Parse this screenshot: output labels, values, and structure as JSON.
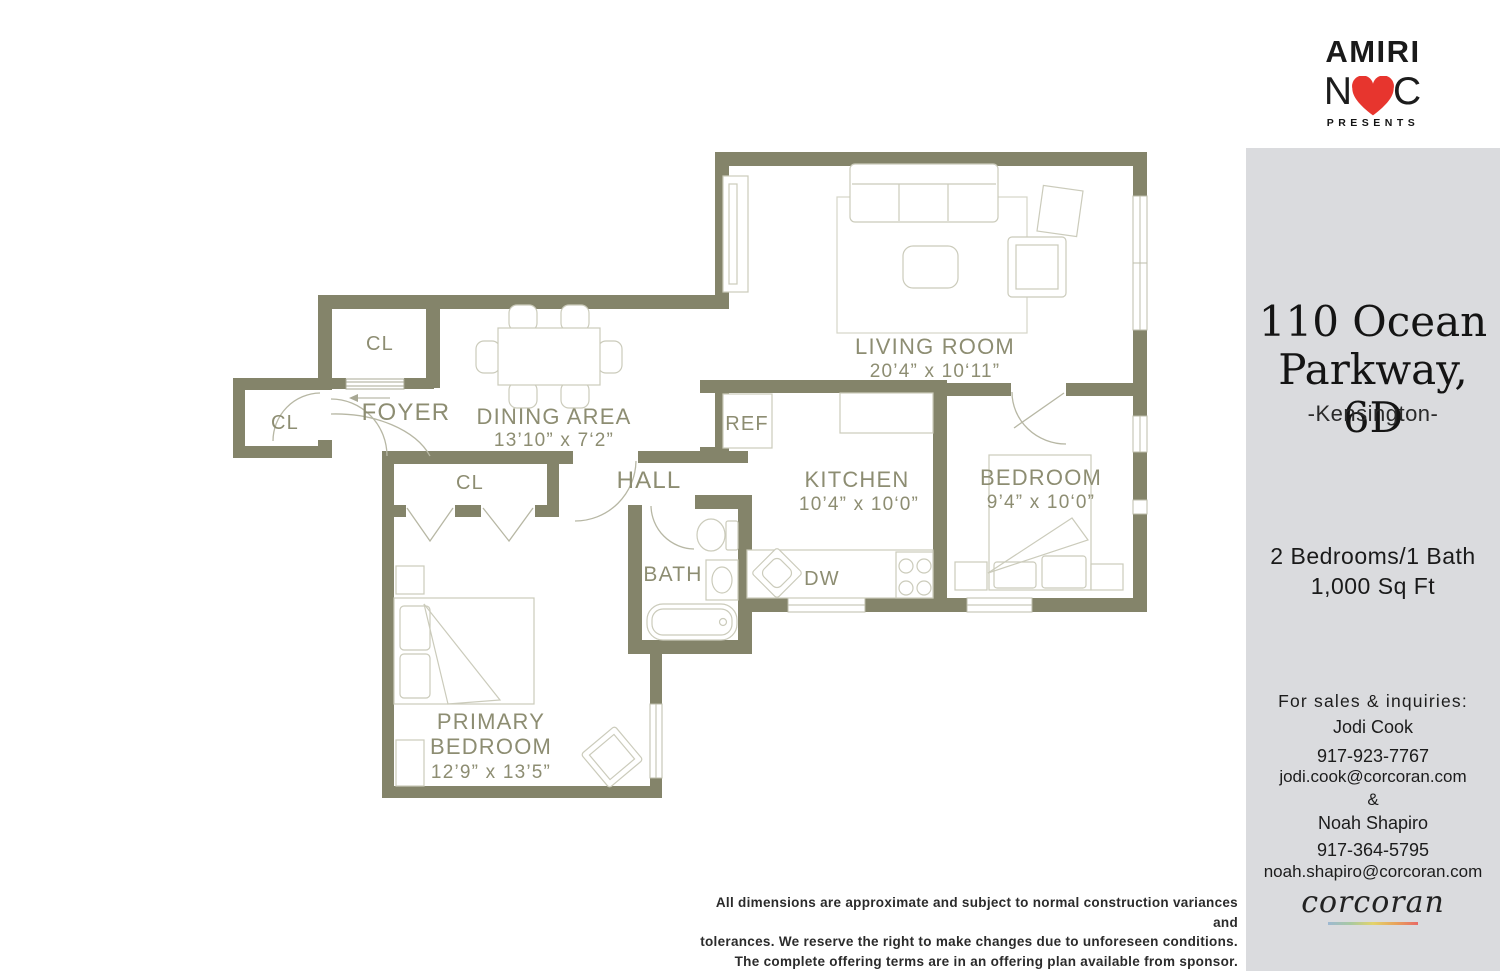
{
  "brand": {
    "name": "AMIRI",
    "monogram_left": "N",
    "monogram_right": "C",
    "presents": "PRESENTS",
    "heart_color": "#e7352e"
  },
  "sidebar": {
    "address_line1": "110 Ocean",
    "address_line2": "Parkway, 6D",
    "neighborhood": "-Kensington-",
    "beds_baths": "2 Bedrooms/1 Bath",
    "area": "1,000 Sq Ft",
    "contact_heading": "For sales & inquiries:",
    "agents": [
      {
        "name": "Jodi Cook",
        "phone": "917-923-7767",
        "email": "jodi.cook@corcoran.com"
      },
      {
        "name": "Noah Shapiro",
        "phone": "917-364-5795",
        "email": "noah.shapiro@corcoran.com"
      }
    ],
    "separator": "&",
    "brokerage": "corcoran"
  },
  "floorplan": {
    "living_room": {
      "label": "LIVING ROOM",
      "dims": "20’4” x 10‘11”"
    },
    "dining_area": {
      "label": "DINING AREA",
      "dims": "13’10” x 7‘2”"
    },
    "kitchen": {
      "label": "KITCHEN",
      "dims": "10’4” x 10‘0”"
    },
    "bedroom": {
      "label": "BEDROOM",
      "dims": "9’4” x 10‘0”"
    },
    "primary_bedroom": {
      "label_line1": "PRIMARY",
      "label_line2": "BEDROOM",
      "dims": "12’9” x 13’5”"
    },
    "foyer": "FOYER",
    "hall": "HALL",
    "bath": "BATH",
    "closet": "CL",
    "ref": "REF",
    "dishwasher": "DW"
  },
  "disclaimer": {
    "line1": "All dimensions are approximate and subject to normal construction variances and",
    "line2": "tolerances. We reserve the right to make changes due to unforeseen conditions.",
    "line3": "The complete offering terms are in an offering plan available from sponsor."
  },
  "colors": {
    "wall": "#84846a",
    "room_label": "#8d8d72",
    "furniture_line": "#cbcbbb",
    "sidebar_bg": "#dadbde",
    "heart": "#e7352e",
    "corcoran_gradient": [
      "#9db8d2",
      "#a8c9a1",
      "#e3d36b",
      "#e8a45c",
      "#e86a66"
    ]
  }
}
